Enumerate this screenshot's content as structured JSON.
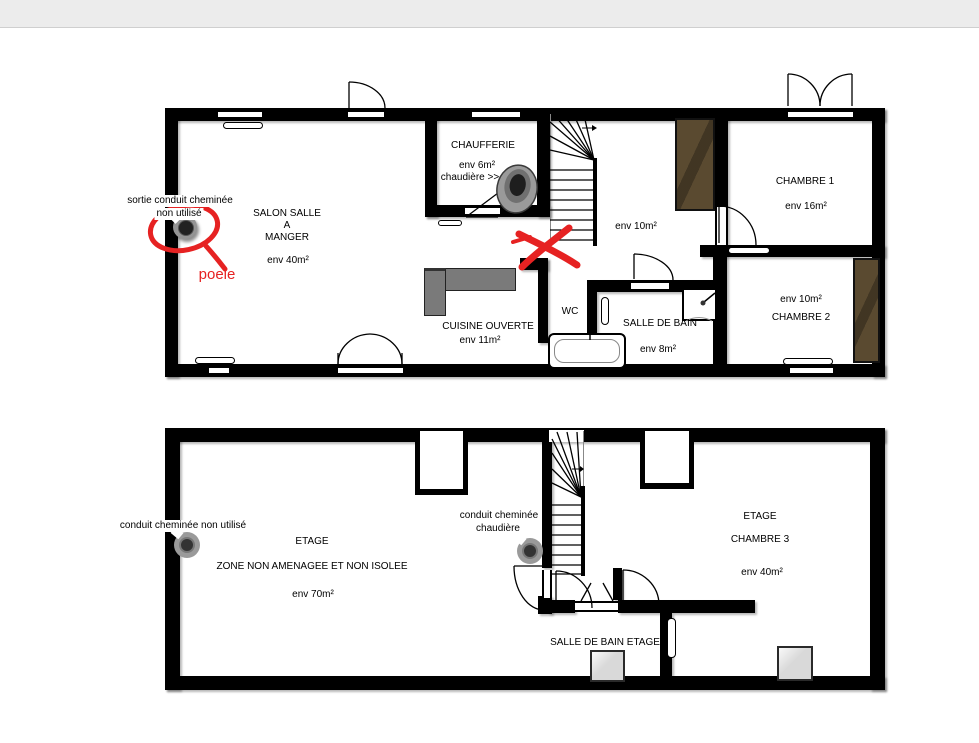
{
  "colors": {
    "wall": "#000000",
    "annotation_red": "#e62222",
    "wardrobe": "#5a4a30",
    "kitchen_counter": "#7a7a7a",
    "roof_window": "#d9d9d9",
    "topbar_bg": "#ececec"
  },
  "floor1": {
    "chaufferie": {
      "title": "CHAUFFERIE",
      "area": "env 6m²",
      "note": "chaudière >>"
    },
    "salon": {
      "line1": "SALON SALLE",
      "line2": "A",
      "line3": "MANGER",
      "area": "env 40m²"
    },
    "hallway": {
      "area": "env 10m²"
    },
    "chambre1": {
      "title": "CHAMBRE 1",
      "area": "env 16m²"
    },
    "chambre2": {
      "title": "CHAMBRE 2",
      "area": "env 10m²"
    },
    "wc": {
      "title": "WC"
    },
    "salle_de_bain": {
      "title": "SALLE DE BAIN",
      "area": "env 8m²"
    },
    "cuisine": {
      "title": "CUISINE OUVERTE",
      "area": "env 11m²"
    },
    "annotation_sortie_line1": "sortie conduit cheminée",
    "annotation_sortie_line2": "non utilisé",
    "annotation_poele": "poele"
  },
  "floor2": {
    "zone": {
      "title": "ETAGE",
      "line2": "ZONE NON AMENAGEE ET NON ISOLEE",
      "area": "env 70m²"
    },
    "chambre3": {
      "title": "ETAGE",
      "line2": "CHAMBRE 3",
      "area": "env 40m²"
    },
    "salle_de_bain_etage": {
      "title": "SALLE DE BAIN ETAGE"
    },
    "annotation_conduit1": "conduit cheminée non utilisé",
    "annotation_conduit2_line1": "conduit cheminée",
    "annotation_conduit2_line2": "chaudière"
  }
}
